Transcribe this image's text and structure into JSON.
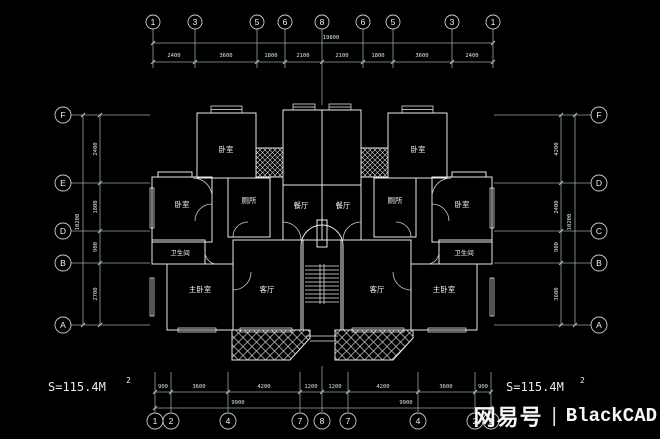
{
  "watermark": {
    "brand": "网易号",
    "divider": "|",
    "name": "BlackCAD"
  },
  "area": {
    "label": "S=115.4M",
    "sup": "2"
  },
  "grid_bubbles": {
    "top": [
      "1",
      "3",
      "5",
      "6",
      "8",
      "6",
      "5",
      "3",
      "1"
    ],
    "bottom": [
      "1",
      "2",
      "4",
      "7",
      "8",
      "7",
      "4",
      "2",
      "1"
    ],
    "left": [
      "F",
      "E",
      "D",
      "B",
      "A"
    ],
    "right": [
      "F",
      "D",
      "C",
      "B",
      "A"
    ]
  },
  "dimensions": {
    "top_segments": [
      "2400",
      "3600",
      "1800",
      "2100",
      "2100",
      "1800",
      "3600",
      "2400"
    ],
    "top_overall": "19800",
    "bottom_segments": [
      "900",
      "3600",
      "4200",
      "1200",
      "1200",
      "4200",
      "3600",
      "900"
    ],
    "bottom_overall_left": "9900",
    "bottom_overall_right": "9900",
    "left_segments": [
      "2400",
      "1800",
      "900",
      "2700"
    ],
    "left_overall": "10200",
    "right_segments": [
      "4200",
      "2400",
      "900",
      "3600"
    ],
    "right_overall": "10200"
  },
  "rooms": {
    "left": {
      "bedroom_top": "卧室",
      "bedroom_side": "卧室",
      "toilet": "厕所",
      "dining": "餐厅",
      "bath": "卫生间",
      "master": "主卧室",
      "living": "客厅"
    },
    "right": {
      "bedroom_top": "卧室",
      "bedroom_side": "卧室",
      "toilet": "厕所",
      "dining": "餐厅",
      "bath": "卫生间",
      "master": "主卧室",
      "living": "客厅"
    }
  },
  "colors": {
    "background": "#000000",
    "walls": "#e9e9e9",
    "axes": "#92ab96",
    "text": "#f2f2f2"
  }
}
